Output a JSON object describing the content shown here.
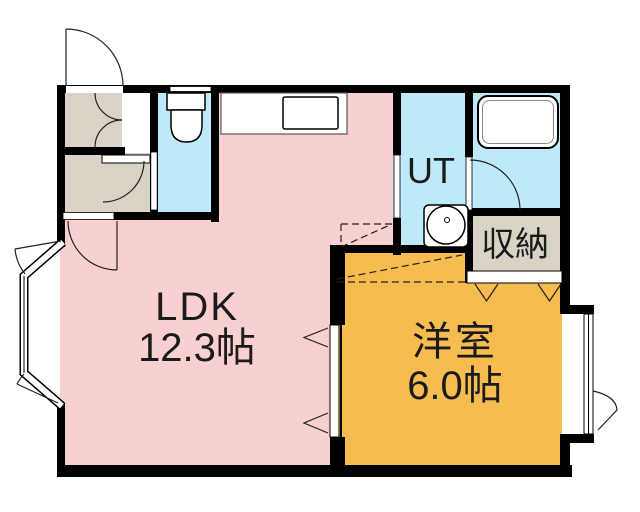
{
  "plan": {
    "wall_color": "#000000",
    "rooms": {
      "ldk": {
        "label": "LDK",
        "area": "12.3帖",
        "color": "#F8D0D0"
      },
      "western_room": {
        "label": "洋室",
        "area": "6.0帖",
        "color": "#F6BC4F"
      },
      "utility": {
        "label": "UT",
        "color": "#BEE9F8"
      },
      "storage": {
        "label": "収納",
        "color": "#D8D3C5"
      },
      "toilet": {
        "color": "#BEE9F8"
      },
      "bathroom": {
        "color": "#BEE9F8"
      },
      "entry": {
        "color": "#D8D3C5"
      }
    },
    "fixtures": {
      "toilet": "toilet-icon",
      "kitchen_counter": "kitchen-counter-icon",
      "kitchen_sink": "kitchen-sink-icon",
      "bathtub": "bathtub-icon",
      "wash_basin": "wash-basin-icon"
    }
  }
}
